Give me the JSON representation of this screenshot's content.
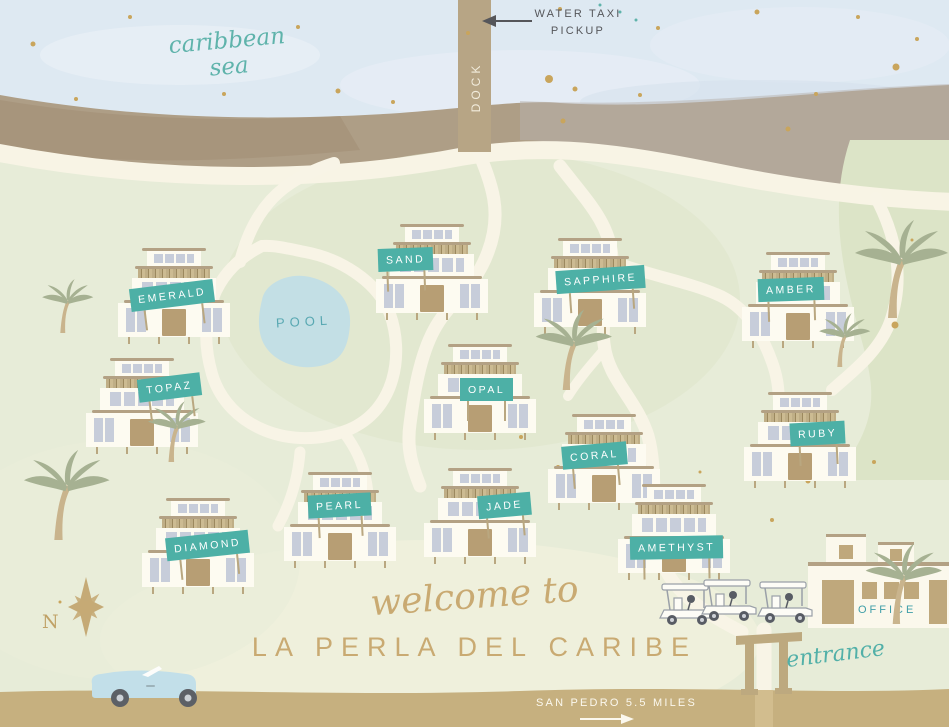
{
  "title": {
    "welcome_script": "welcome to",
    "resort_name": "LA PERLA DEL CARIBE"
  },
  "labels": {
    "sea": "caribbean sea",
    "water_taxi_line1": "WATER TAXI",
    "water_taxi_line2": "PICKUP",
    "dock": "DOCK",
    "pool": "POOL",
    "entrance": "entrance",
    "office": "OFFICE",
    "compass_north": "N",
    "road_sign": "SAN PEDRO  5.5 MILES"
  },
  "villas": [
    {
      "label": "EMERALD"
    },
    {
      "label": "SAND"
    },
    {
      "label": "SAPPHIRE"
    },
    {
      "label": "AMBER"
    },
    {
      "label": "TOPAZ"
    },
    {
      "label": "OPAL"
    },
    {
      "label": "CORAL"
    },
    {
      "label": "RUBY"
    },
    {
      "label": "PEARL"
    },
    {
      "label": "JADE"
    },
    {
      "label": "DIAMOND"
    },
    {
      "label": "AMETHYST"
    }
  ],
  "colors": {
    "sign_teal": "#4db0a6",
    "script_teal": "#52b0a8",
    "tan_text": "#c9aa72",
    "sea": "#dee9f2",
    "land": "#e7ecd8",
    "road": "#c6b07f",
    "beach": "#ae9e86",
    "pool": "#c3dfe5"
  }
}
